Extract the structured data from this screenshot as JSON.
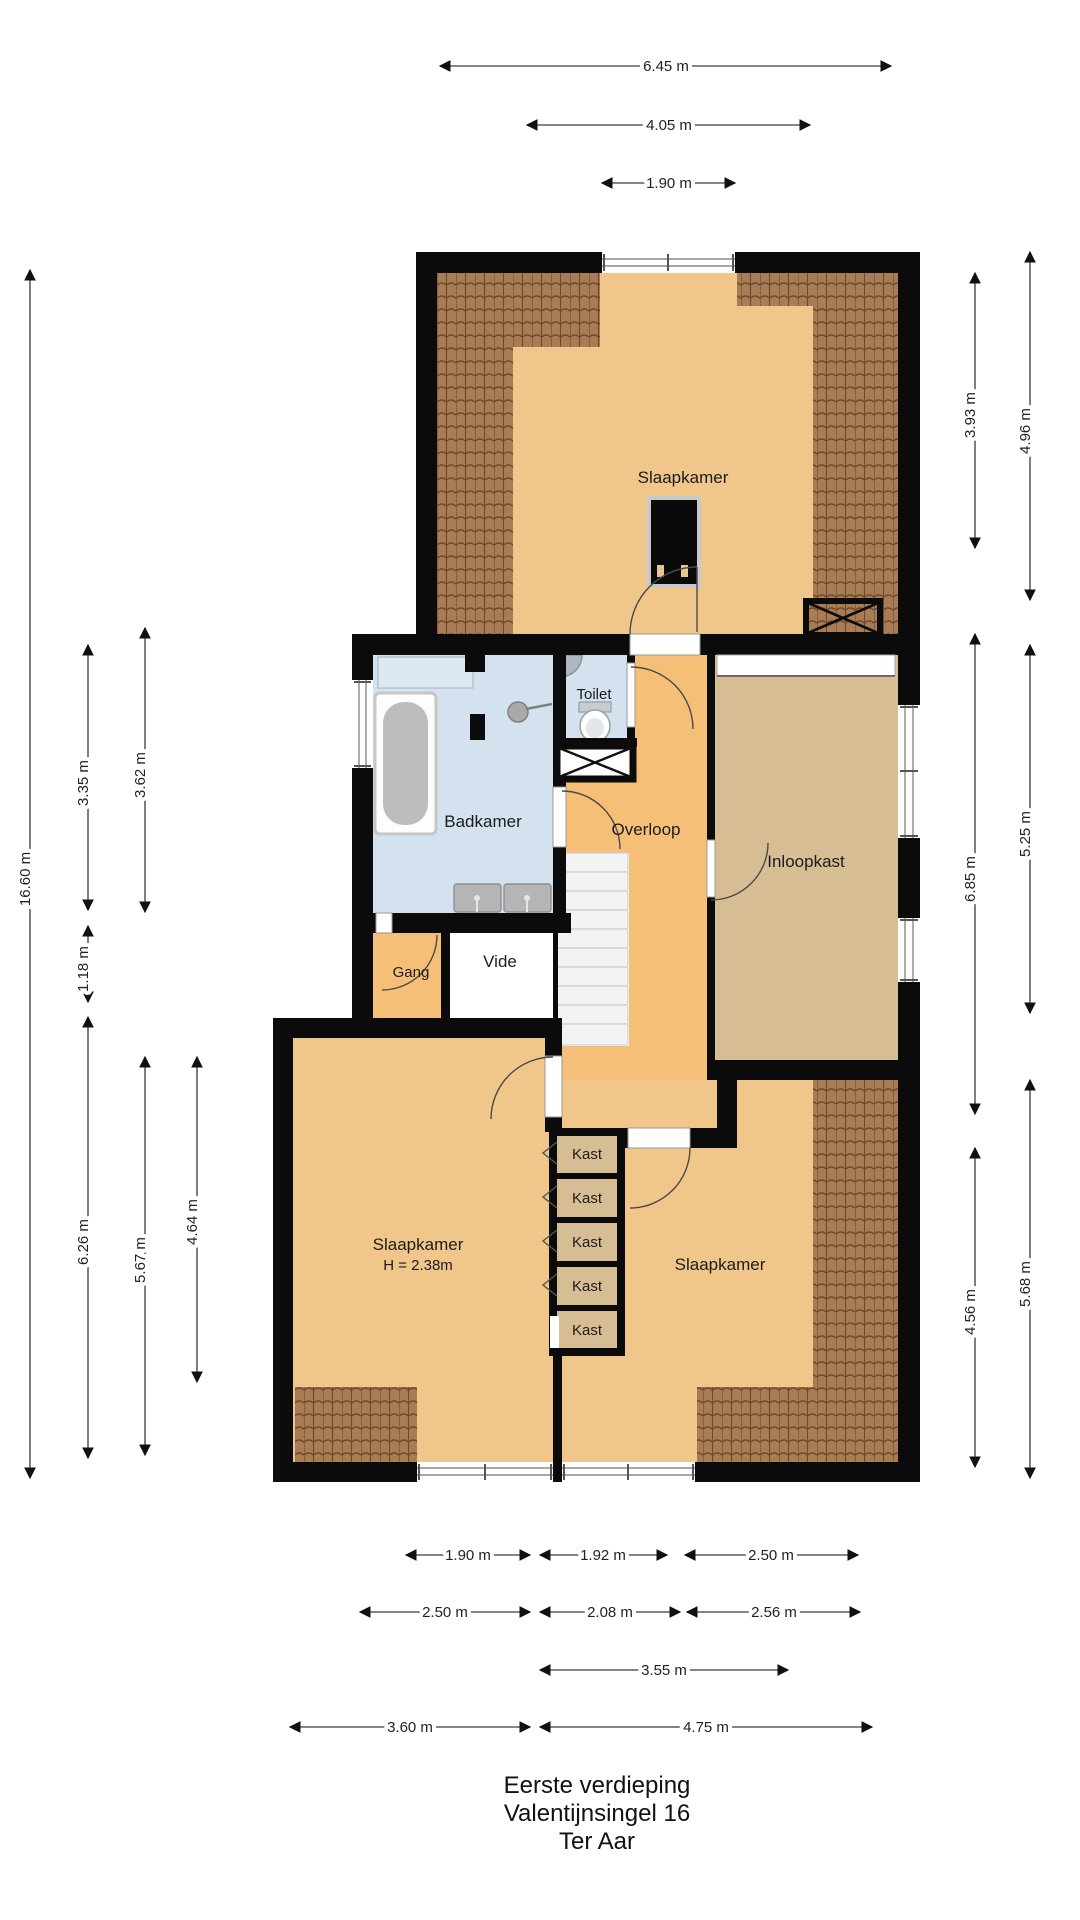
{
  "title_block": {
    "line1": "Eerste verdieping",
    "line2": "Valentijnsingel 16",
    "line3": "Ter Aar"
  },
  "rooms": {
    "slaapkamer_top": {
      "label": "Slaapkamer"
    },
    "toilet": {
      "label": "Toilet"
    },
    "badkamer": {
      "label": "Badkamer"
    },
    "overloop": {
      "label": "Overloop"
    },
    "inloopkast": {
      "label": "Inloopkast"
    },
    "gang": {
      "label": "Gang"
    },
    "vide": {
      "label": "Vide"
    },
    "slaapkamer_left": {
      "label": "Slaapkamer",
      "height_note": "H = 2.38m"
    },
    "slaapkamer_right": {
      "label": "Slaapkamer"
    },
    "kast": {
      "label": "Kast",
      "count": 5
    }
  },
  "dimensions": {
    "top": [
      {
        "label": "6.45 m"
      },
      {
        "label": "4.05 m"
      },
      {
        "label": "1.90 m"
      }
    ],
    "left": [
      {
        "label": "16.60 m"
      },
      {
        "label": "3.35 m"
      },
      {
        "label": "3.62 m"
      },
      {
        "label": "1.18 m"
      },
      {
        "label": "6.26 m"
      },
      {
        "label": "5.67 m"
      },
      {
        "label": "4.64 m"
      }
    ],
    "right": [
      {
        "label": "4.96 m"
      },
      {
        "label": "3.93 m"
      },
      {
        "label": "5.25 m"
      },
      {
        "label": "6.85 m"
      },
      {
        "label": "5.68 m"
      },
      {
        "label": "4.56 m"
      }
    ],
    "bottom": [
      {
        "label": "1.90 m"
      },
      {
        "label": "1.92 m"
      },
      {
        "label": "2.50 m"
      },
      {
        "label": "2.50 m"
      },
      {
        "label": "2.08 m"
      },
      {
        "label": "2.56 m"
      },
      {
        "label": "3.55 m"
      },
      {
        "label": "3.60 m"
      },
      {
        "label": "4.75 m"
      }
    ]
  },
  "colors": {
    "wall": "#0b0b0b",
    "floor_bedroom": "#f0c68a",
    "floor_hall": "#f5bf78",
    "floor_closet": "#d7bd94",
    "floor_bath": "#d4e1ef",
    "roof_tiles": "#a87c55",
    "background": "#ffffff"
  }
}
